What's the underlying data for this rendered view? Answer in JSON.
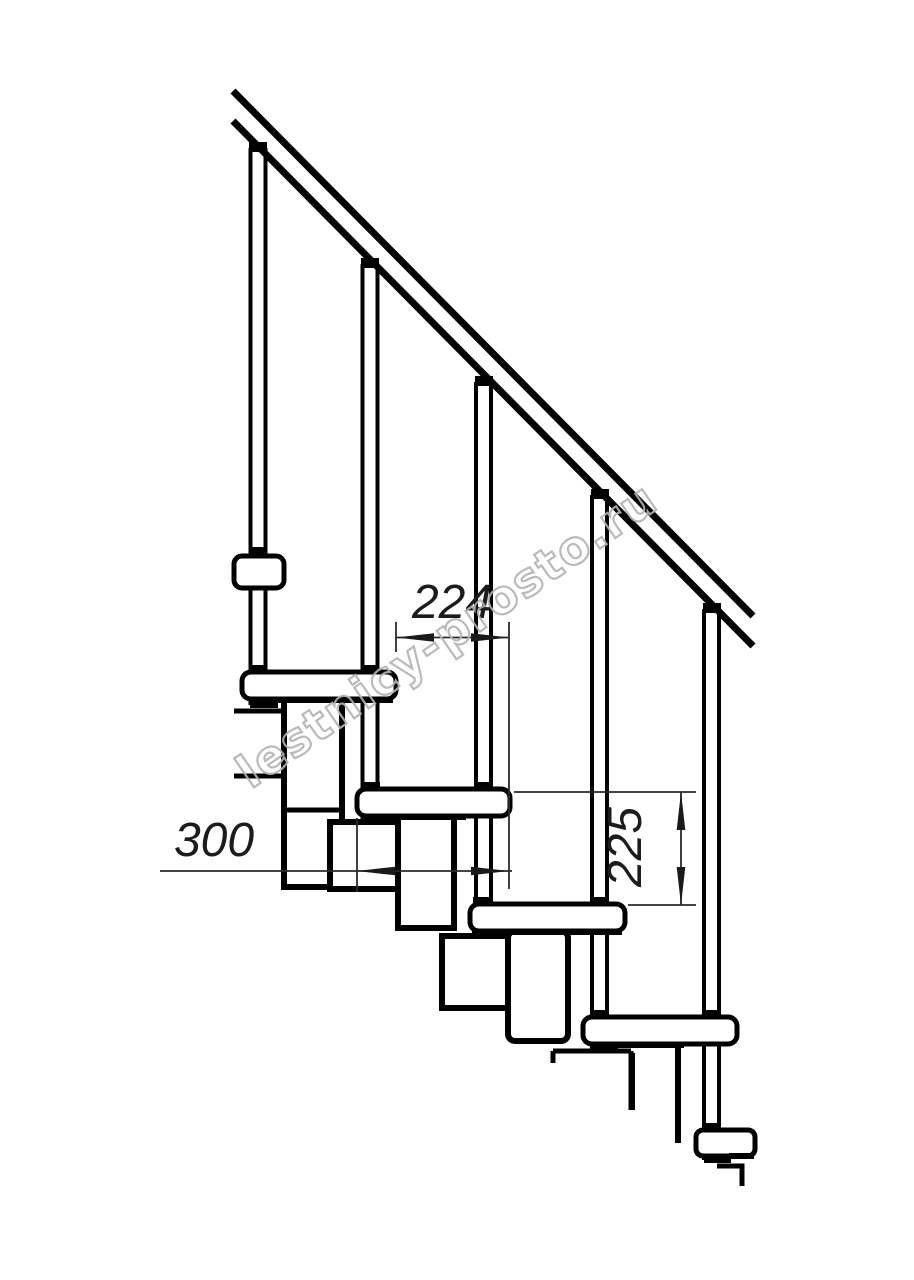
{
  "page": {
    "background": "#ffffff"
  },
  "colors": {
    "line": "#000000",
    "dimension_line": "#2a2a2a",
    "dimension_text": "#1c1c1c",
    "watermark": "#b3b3b3"
  },
  "dimensions": {
    "step_run": {
      "value": "224"
    },
    "tread_depth": {
      "value": "300"
    },
    "riser_height": {
      "value": "225"
    }
  },
  "watermark": {
    "text": "lestnicy-prosto.ru"
  }
}
